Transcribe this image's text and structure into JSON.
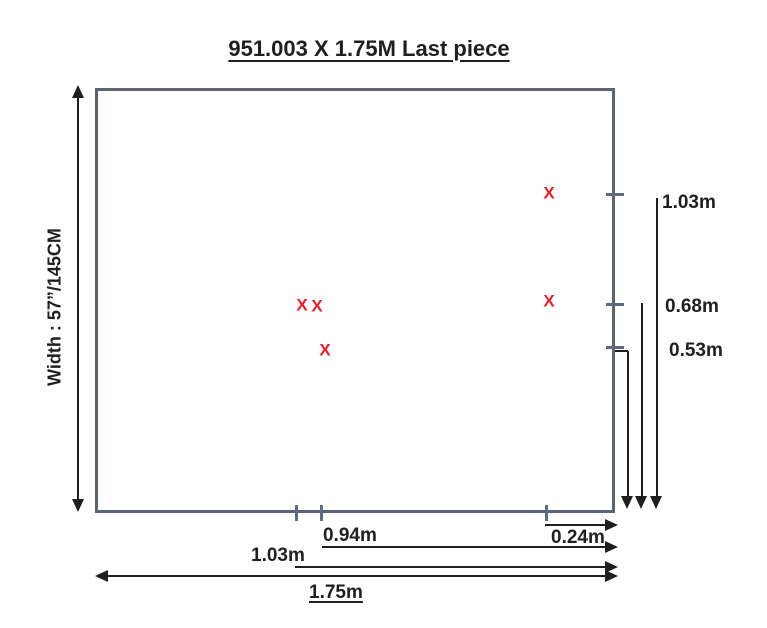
{
  "title": "951.003 X 1.75M Last piece",
  "fabric": {
    "width_label": "Width : 57”/145CM"
  },
  "defects": [
    {
      "glyph": "X"
    },
    {
      "glyph": "X"
    },
    {
      "glyph": "X"
    },
    {
      "glyph": "X"
    },
    {
      "glyph": "X"
    }
  ],
  "right_dims": [
    {
      "label": "1.03m"
    },
    {
      "label": "0.68m"
    },
    {
      "label": "0.53m"
    }
  ],
  "bottom_dims": [
    {
      "label": "0.24m"
    },
    {
      "label": "0.94m"
    },
    {
      "label": "1.03m"
    },
    {
      "label": "1.75m"
    }
  ],
  "colors": {
    "defect_red": "#ec1c24",
    "fabric_outline": "#5a6474",
    "dimension_line": "#1f1f1f"
  }
}
